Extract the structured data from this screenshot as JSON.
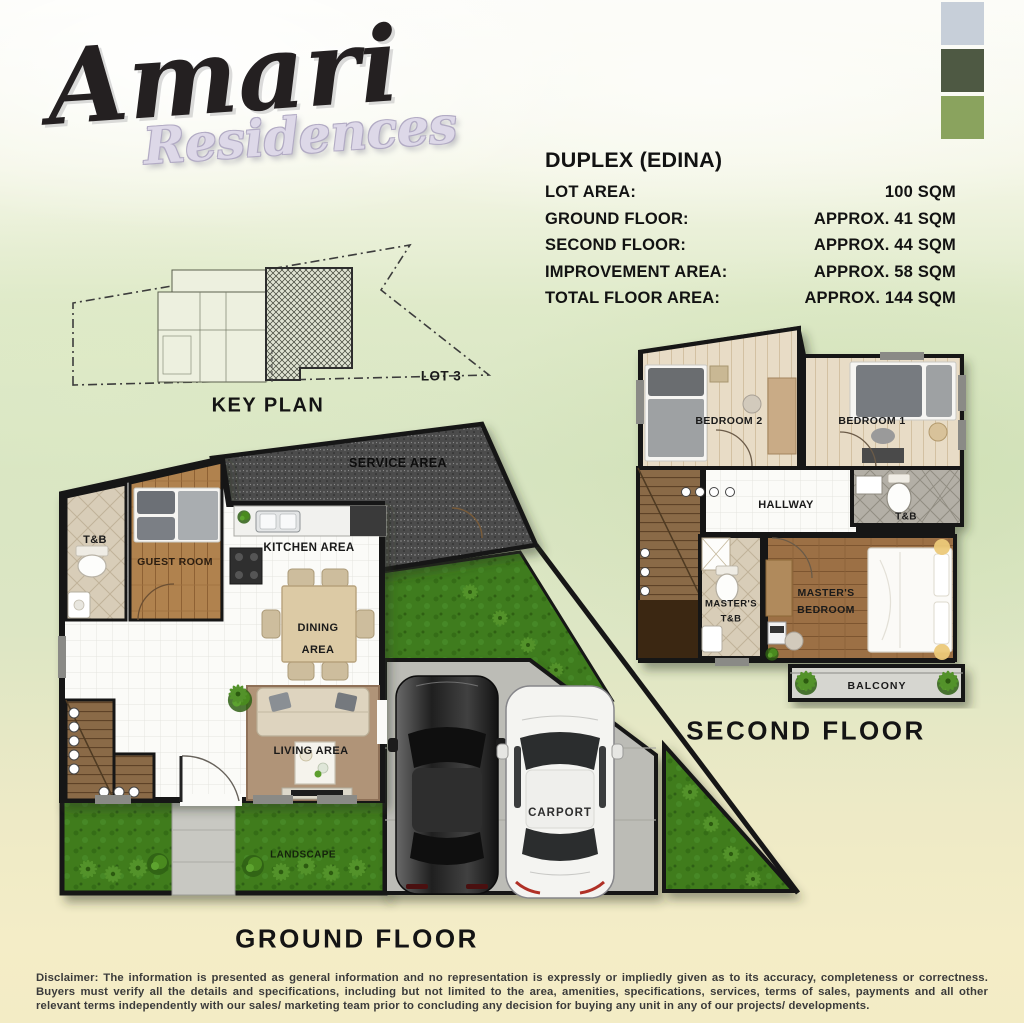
{
  "brand": {
    "name": "Amari",
    "subtitle": "Residences"
  },
  "palette": {
    "swatch_1": "#c7cfd9",
    "swatch_2": "#4e5943",
    "swatch_3": "#8aa35e"
  },
  "specs": {
    "title": "DUPLEX (EDINA)",
    "rows": [
      {
        "label": "LOT AREA:",
        "value": "100 SQM"
      },
      {
        "label": "GROUND FLOOR:",
        "value": "APPROX. 41 SQM"
      },
      {
        "label": "SECOND FLOOR:",
        "value": "APPROX. 44 SQM"
      },
      {
        "label": "IMPROVEMENT AREA:",
        "value": "APPROX. 58 SQM"
      },
      {
        "label": "TOTAL FLOOR AREA:",
        "value": "APPROX. 144 SQM"
      }
    ]
  },
  "key_plan": {
    "caption": "KEY PLAN",
    "lot_label": "LOT 3"
  },
  "ground_floor": {
    "caption": "GROUND FLOOR",
    "labels": {
      "service_area": "SERVICE AREA",
      "toilet_bath": "T&B",
      "guest_room": "GUEST ROOM",
      "kitchen_area": "KITCHEN AREA",
      "dining_line1": "DINING",
      "dining_line2": "AREA",
      "living_area": "LIVING AREA",
      "landscape": "LANDSCAPE",
      "carport": "CARPORT"
    }
  },
  "second_floor": {
    "caption": "SECOND FLOOR",
    "labels": {
      "bedroom_2": "BEDROOM 2",
      "bedroom_1": "BEDROOM 1",
      "hallway": "HALLWAY",
      "toilet_bath": "T&B",
      "masters_tb_line1": "MASTER'S",
      "masters_tb_line2": "T&B",
      "masters_bedroom_line1": "MASTER'S",
      "masters_bedroom_line2": "BEDROOM",
      "balcony": "BALCONY"
    }
  },
  "disclaimer": "Disclaimer: The information is presented as general information and no representation is expressly or impliedly given as to its accuracy, completeness or correctness. Buyers must verify all the details and specifications, including but not limited to the area, amenities, specifications, services, terms of sales, payments and all other relevant terms independently with our sales/ marketing team prior to concluding any decision for buying any unit in any of our projects/ developments."
}
